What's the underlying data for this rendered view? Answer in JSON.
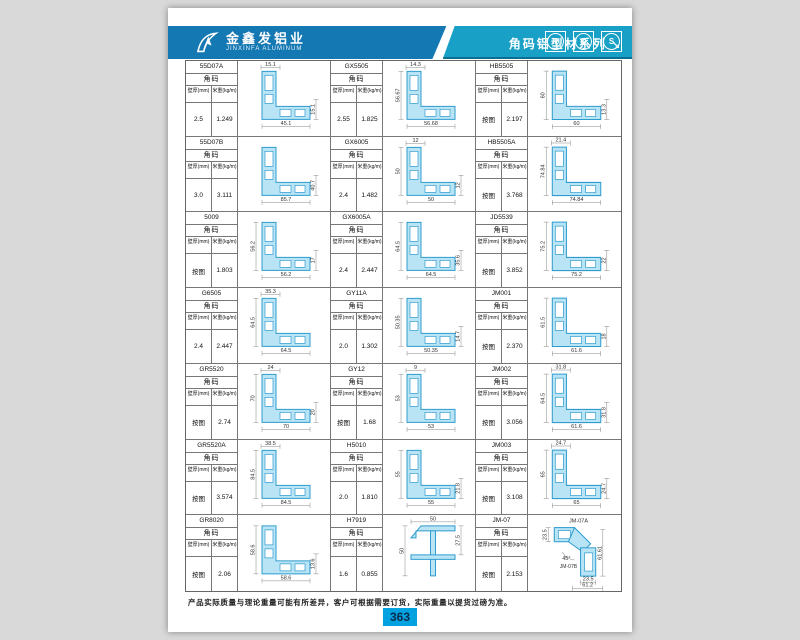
{
  "header": {
    "brand_cn": "金鑫发铝业",
    "brand_en": "JINXINFA ALUMINUM",
    "series_title": "角码铝型材系列",
    "arrow": "↘",
    "cert_icons": [
      {
        "glyph": "R"
      },
      {
        "glyph": "O"
      },
      {
        "glyph": "S"
      }
    ]
  },
  "table": {
    "category_label": "角码",
    "thickness_label": "壁厚(mm)",
    "weight_label": "米重(kg/m)"
  },
  "cells": [
    {
      "model": "55D07A",
      "thickness": "2.5",
      "weight": "1.249",
      "shape": "L",
      "dims": {
        "top": "15.1",
        "bottom": "45.1",
        "right": "15.1"
      }
    },
    {
      "model": "GX5505",
      "thickness": "2.55",
      "weight": "1.825",
      "shape": "L",
      "dims": {
        "top": "14.3",
        "left": "56.67",
        "bottom": "56.68"
      }
    },
    {
      "model": "HB5505",
      "thickness": "按图",
      "weight": "2.197",
      "shape": "L",
      "dims": {
        "left": "60",
        "bottom": "60",
        "right": "13.3"
      }
    },
    {
      "model": "55D07B",
      "thickness": "3.0",
      "weight": "3.111",
      "shape": "L",
      "dims": {
        "bottom": "85.7",
        "right": "40.7"
      }
    },
    {
      "model": "GX6005",
      "thickness": "2.4",
      "weight": "1.482",
      "shape": "L",
      "dims": {
        "top": "12",
        "left": "50",
        "bottom": "50",
        "right": "12"
      }
    },
    {
      "model": "HB5505A",
      "thickness": "按图",
      "weight": "3.768",
      "shape": "L",
      "dims": {
        "top": "21.4",
        "left": "74.84",
        "bottom": "74.84"
      }
    },
    {
      "model": "5009",
      "thickness": "按图",
      "weight": "1.803",
      "shape": "L",
      "dims": {
        "left": "56.2",
        "bottom": "56.2",
        "right": "17"
      }
    },
    {
      "model": "GX6005A",
      "thickness": "2.4",
      "weight": "2.447",
      "shape": "L",
      "dims": {
        "left": "64.5",
        "bottom": "64.5",
        "right": "35.6"
      }
    },
    {
      "model": "JD5539",
      "thickness": "按图",
      "weight": "3.852",
      "shape": "L",
      "dims": {
        "left": "75.2",
        "bottom": "75.2",
        "right": "22"
      }
    },
    {
      "model": "G6505",
      "thickness": "2.4",
      "weight": "2.447",
      "shape": "L",
      "dims": {
        "top": "35.3",
        "left": "64.5",
        "bottom": "64.5"
      }
    },
    {
      "model": "GY11A",
      "thickness": "2.0",
      "weight": "1.302",
      "shape": "L",
      "dims": {
        "left": "50.35",
        "bottom": "50.35",
        "right": "14.7"
      }
    },
    {
      "model": "JM001",
      "thickness": "按图",
      "weight": "2.370",
      "shape": "L",
      "dims": {
        "left": "61.5",
        "bottom": "61.6",
        "right": "18"
      }
    },
    {
      "model": "GR5520",
      "thickness": "按图",
      "weight": "2.74",
      "shape": "L",
      "dims": {
        "top": "24",
        "left": "70",
        "bottom": "70",
        "right": "20"
      }
    },
    {
      "model": "GY12",
      "thickness": "按图",
      "weight": "1.68",
      "shape": "L",
      "dims": {
        "top": "9",
        "left": "53",
        "bottom": "53"
      }
    },
    {
      "model": "JM002",
      "thickness": "按图",
      "weight": "3.056",
      "shape": "L",
      "dims": {
        "top": "31.8",
        "left": "64.5",
        "bottom": "61.6",
        "right": "31.8"
      }
    },
    {
      "model": "GR5520A",
      "thickness": "按图",
      "weight": "3.574",
      "shape": "L",
      "dims": {
        "top": "38.5",
        "left": "84.5",
        "bottom": "84.5"
      }
    },
    {
      "model": "H5010",
      "thickness": "2.0",
      "weight": "1.810",
      "shape": "L",
      "dims": {
        "left": "55",
        "bottom": "55",
        "right": "21.8"
      }
    },
    {
      "model": "JM003",
      "thickness": "按图",
      "weight": "3.108",
      "shape": "L",
      "dims": {
        "top": "24.7",
        "left": "65",
        "bottom": "65",
        "right": "24.7"
      }
    },
    {
      "model": "GR8020",
      "thickness": "按图",
      "weight": "2.06",
      "shape": "L",
      "dims": {
        "left": "58.6",
        "bottom": "58.6",
        "right": "13.6"
      }
    },
    {
      "model": "H7919",
      "thickness": "1.6",
      "weight": "0.855",
      "shape": "cross",
      "dims": {
        "top": "50",
        "left": "50",
        "right": "27.5"
      }
    },
    {
      "model": "JM-07",
      "thickness": "按图",
      "weight": "2.153",
      "shape": "angled",
      "dims": {
        "top_left": "23.5",
        "right": "61.61",
        "bottom_inner": "23.5",
        "bottom": "61.2"
      },
      "angle": "45°",
      "drawing_labels": [
        "JM-07A",
        "JM-07B"
      ]
    }
  ],
  "footer": {
    "note": "产品实际质量与理论重量可能有所差异，客户可根据需要订货，实际重量以提货过磅为准。",
    "page_number": "363"
  },
  "colors": {
    "band_left": "#1478b2",
    "band_right": "#18a0c6",
    "profile_fill": "#b9e4f6",
    "profile_stroke": "#2f9cce",
    "badge": "#00a2e0"
  }
}
